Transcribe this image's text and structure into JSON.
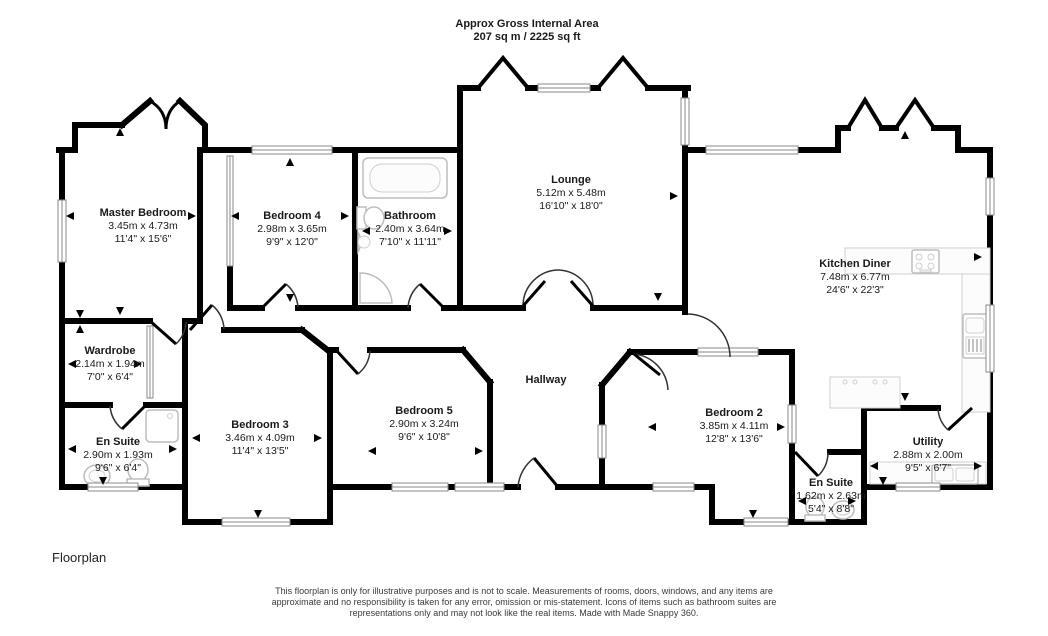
{
  "title": {
    "line1": "Approx Gross Internal Area",
    "line2": "207 sq m / 2225 sq ft"
  },
  "rooms": [
    {
      "name": "Master Bedroom",
      "metric": "3.45m x 4.73m",
      "imperial": "11'4\" x 15'6\""
    },
    {
      "name": "Bedroom 4",
      "metric": "2.98m x 3.65m",
      "imperial": "9'9\" x 12'0\""
    },
    {
      "name": "Bathroom",
      "metric": "2.40m x 3.64m",
      "imperial": "7'10\" x 11'11\""
    },
    {
      "name": "Lounge",
      "metric": "5.12m x 5.48m",
      "imperial": "16'10\" x 18'0\""
    },
    {
      "name": "Kitchen Diner",
      "metric": "7.48m x 6.77m",
      "imperial": "24'6\" x 22'3\""
    },
    {
      "name": "Wardrobe",
      "metric": "2.14m x 1.94m",
      "imperial": "7'0\" x 6'4\""
    },
    {
      "name": "En Suite",
      "metric": "2.90m x 1.93m",
      "imperial": "9'6\" x 6'4\""
    },
    {
      "name": "Bedroom 3",
      "metric": "3.46m x 4.09m",
      "imperial": "11'4\" x 13'5\""
    },
    {
      "name": "Bedroom 5",
      "metric": "2.90m x 3.24m",
      "imperial": "9'6\" x 10'8\""
    },
    {
      "name": "Hallway"
    },
    {
      "name": "Bedroom 2",
      "metric": "3.85m x 4.11m",
      "imperial": "12'8\" x 13'6\""
    },
    {
      "name": "Utility",
      "metric": "2.88m x 2.00m",
      "imperial": "9'5\" x 6'7\""
    },
    {
      "name": "En Suite",
      "metric": "1.62m x 2.63m",
      "imperial": "5'4\" x 8'8\""
    }
  ],
  "footer": {
    "caption": "Floorplan"
  },
  "disclaimer": "This floorplan is only for illustrative purposes and is not to scale. Measurements of rooms, doors, windows, and any items are approximate and no responsibility is taken for any error, omission or mis-statement. Icons of items such as bathroom suites are representations only and may not look like the real items. Made with Made Snappy 360.",
  "colors": {
    "wall": "#000000",
    "window_frame": "#8a8a8a",
    "fixture_outline": "#bdbdbd",
    "text": "#1a1a1a",
    "disclaimer_text": "#3a3a3a"
  }
}
